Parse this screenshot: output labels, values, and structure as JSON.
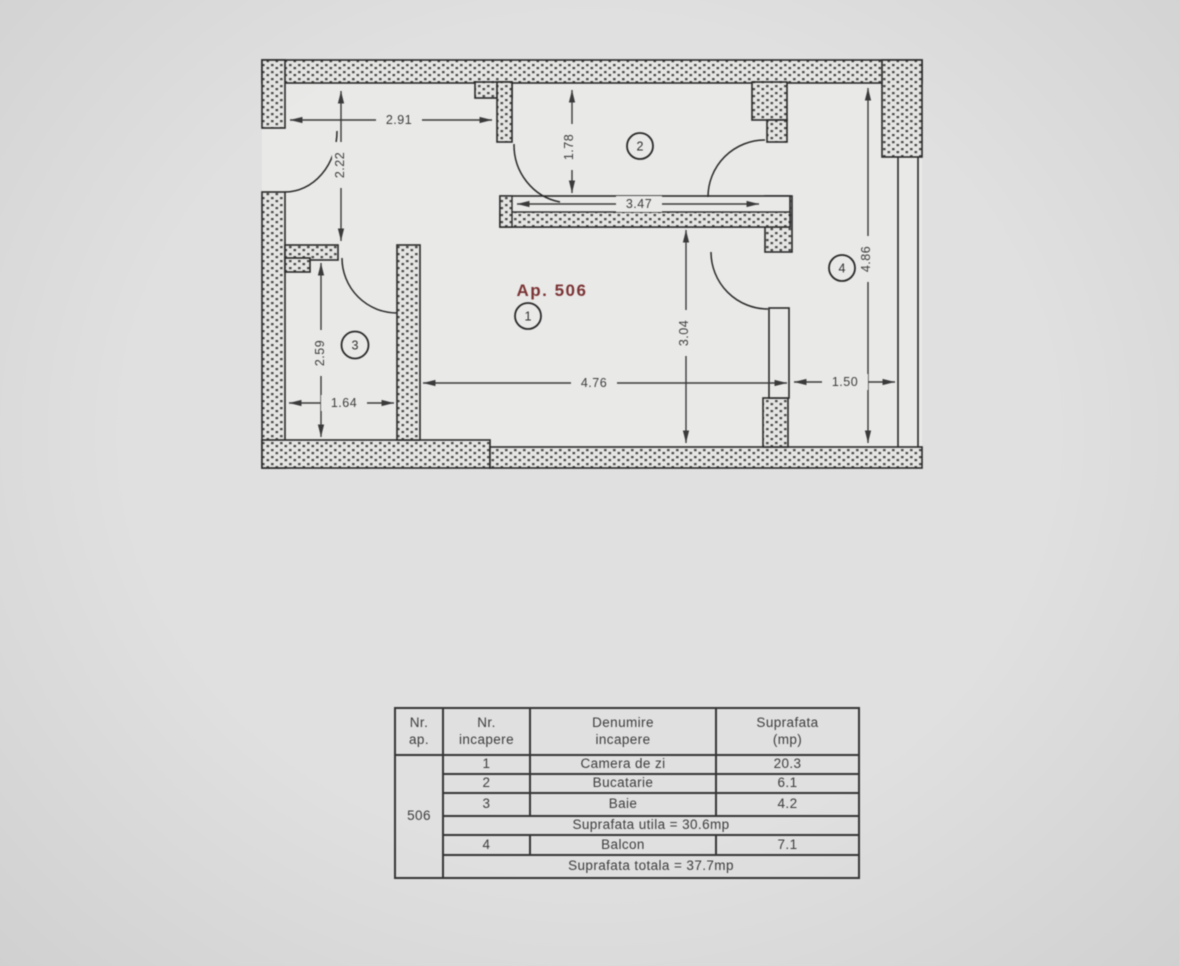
{
  "floorplan": {
    "apartment_label": "Ap. 506",
    "room_markers": {
      "living": "1",
      "kitchen": "2",
      "bathroom": "3",
      "balcony": "4"
    },
    "dimensions": {
      "hall_width": "2.91",
      "hall_depth": "2.22",
      "kitchen_entry": "1.78",
      "kitchen_width": "3.47",
      "living_width": "4.76",
      "living_depth": "3.04",
      "bathroom_width": "1.64",
      "bathroom_depth": "2.59",
      "balcony_width": "1.50",
      "balcony_length": "4.86"
    }
  },
  "table": {
    "headers": [
      {
        "line1": "Nr.",
        "line2": "ap."
      },
      {
        "line1": "Nr.",
        "line2": "incapere"
      },
      {
        "line1": "Denumire",
        "line2": "incapere"
      },
      {
        "line1": "Suprafata",
        "line2": "(mp)"
      }
    ],
    "apartment_number": "506",
    "rows": [
      {
        "nr": "1",
        "name": "Camera de zi",
        "area": "20.3"
      },
      {
        "nr": "2",
        "name": "Bucatarie",
        "area": "6.1"
      },
      {
        "nr": "3",
        "name": "Baie",
        "area": "4.2"
      }
    ],
    "subtotal": "Suprafata utila = 30.6mp",
    "balcony_row": {
      "nr": "4",
      "name": "Balcon",
      "area": "7.1"
    },
    "total": "Suprafata totala = 37.7mp"
  },
  "colors": {
    "accent_red": "#7b3434",
    "line": "#2a2a2a",
    "background": "#e0e0e0",
    "paper": "#e9e9e8"
  }
}
